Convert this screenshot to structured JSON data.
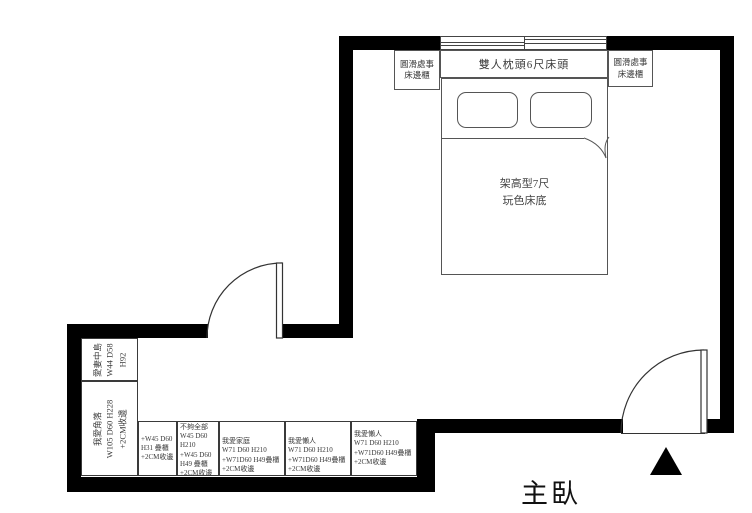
{
  "room": {
    "label": "主臥"
  },
  "bed": {
    "headboard": "雙人枕頭6尺床頭",
    "base": [
      "架高型7尺",
      "玩色床底"
    ]
  },
  "nightstands": {
    "left": [
      "圓滑處事",
      "床邊櫃"
    ],
    "right": [
      "圓滑處事",
      "床邊櫃"
    ]
  },
  "closet": {
    "island": [
      "愛妻中島",
      "W44 D58",
      "H92"
    ],
    "corner": [
      "我愛角落",
      "W105 D60 H228",
      "+2CM收邊"
    ],
    "cells": [
      [
        "+W45 D60",
        "H31 疊櫃",
        "+2CM收邊"
      ],
      [
        "不夠全部",
        "W45 D60",
        "H210",
        "+W45 D60",
        "H49 疊櫃",
        "+2CM收邊"
      ],
      [
        "我愛家庭",
        "W71 D60 H210",
        "+W71D60 H49疊櫃",
        "+2CM收邊"
      ],
      [
        "我愛懶人",
        "W71 D60 H210",
        "+W71D60 H49疊櫃",
        "+2CM收邊"
      ],
      [
        "我愛懶人",
        "W71 D60 H210",
        "+W71D60 H49疊櫃",
        "+2CM收邊"
      ]
    ]
  },
  "colors": {
    "wall": "#000000",
    "furniture_line": "#555555",
    "unit_line": "#3a3a3a",
    "text": "#3a3a3a"
  }
}
